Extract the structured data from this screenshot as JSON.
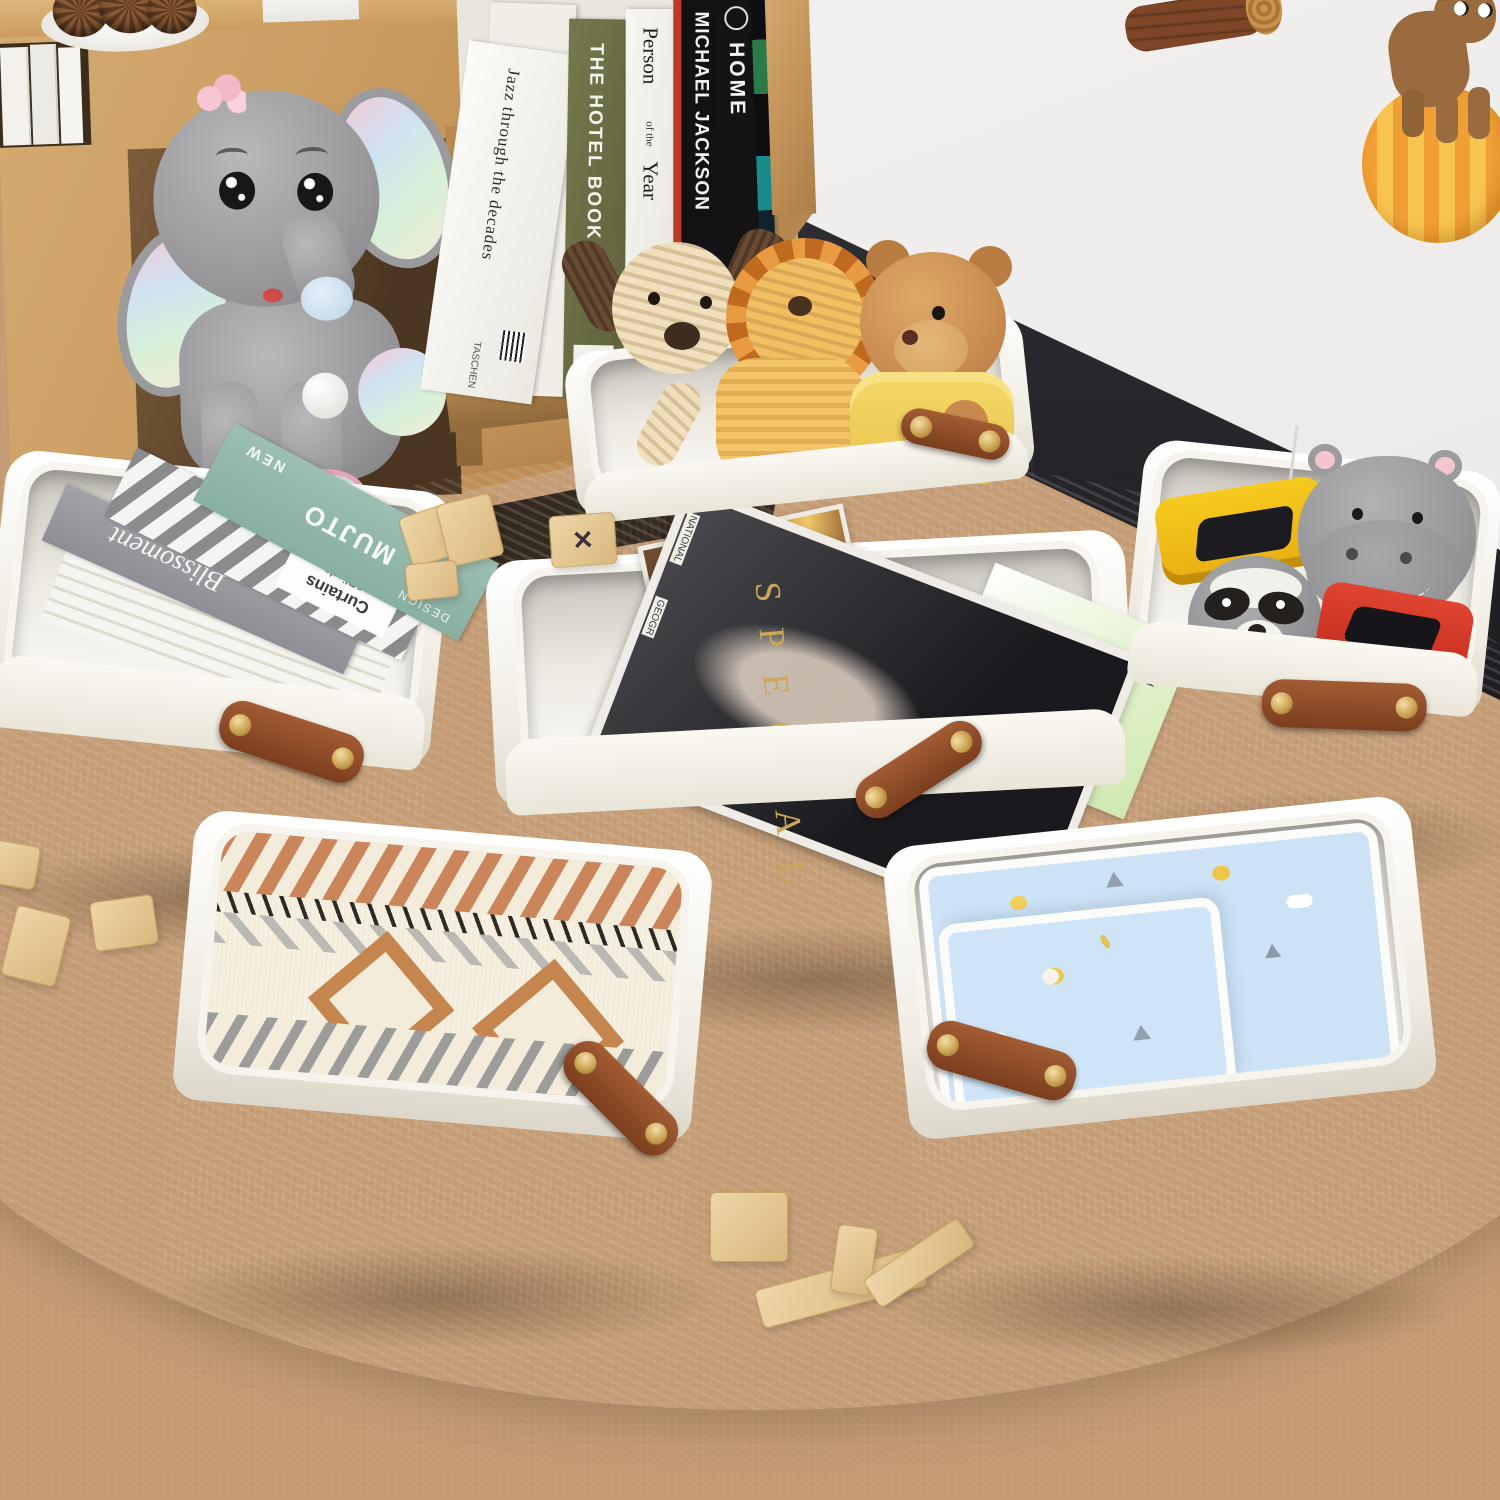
{
  "scene": {
    "type": "product-photo",
    "subject": "Six collapsible two-tone fabric storage baskets (white top, black bottom, brown leather handles with gold rivets) arranged on a round white fluffy rug in a kids playroom",
    "environment": [
      "wooden cube bookshelf",
      "plush elephant in cubby",
      "white wall",
      "dark baseboard",
      "tan carpet floor",
      "wall stickers: log and bear on striped ball",
      "scattered wooden toy blocks",
      "white plate with pinecones"
    ],
    "colors": {
      "carpet_tan": "#c49b73",
      "rug_white": "#f6f4f0",
      "wall_white": "#f0efed",
      "baseboard_dark": "#222228",
      "shelf_wood": "#c59659",
      "basket_white": "#f4f0e7",
      "basket_black": "#17171a",
      "handle_brown": "#8a4a26",
      "rivet_gold": "#c69d4c",
      "elephant_gray": "#9c9c9e",
      "lion_orange": "#e89b40",
      "teddy_brown": "#c8894e",
      "blanket_terracotta": "#c8845a",
      "baby_blanket_blue": "#cde3f5"
    }
  },
  "shelf_books": {
    "jazz": {
      "title": "Jazz through the decades",
      "publisher": "TASCHEN"
    },
    "hotel": {
      "title": "THE HOTEL BOOK"
    },
    "person": {
      "l1": "Person",
      "l2": "of the",
      "l3": "Year",
      "small": "TIM"
    },
    "michael": {
      "title": "MICHAEL JACKSON"
    },
    "home": {
      "title": "HOME"
    }
  },
  "basket_books": {
    "blissoment": "Blissoment",
    "curtains_l1": "Curtains",
    "curtains_l2": "&Blinds",
    "design": "DESIGN",
    "brand": "MUJTO",
    "new": "NEW"
  },
  "magazines": {
    "special": "SPECIAL",
    "natgeo_l1": "NATIONAL",
    "natgeo_l2": "GEOGR",
    "r_letter": "R"
  },
  "blocks": {
    "x_mark": "✕"
  },
  "baskets": [
    {
      "id": "toys-plush",
      "contents": "cream corduroy dog, orange corduroy lion, teddy bear in yellow hoodie"
    },
    {
      "id": "toy-cars",
      "contents": "yellow toy car, gray hippo plush, raccoon plush, red toy car"
    },
    {
      "id": "binders",
      "contents": "Blissoment book, Curtains & Blinds striped book, MUJTO DESIGN NEW teal book"
    },
    {
      "id": "magazines",
      "contents": "SPECIAL fashion magazine, green R magazine, amber photo magazine"
    },
    {
      "id": "knit-blanket",
      "contents": "aztec pattern knit blanket in cream, terracotta, gray, black"
    },
    {
      "id": "baby-blanket",
      "contents": "folded light blue baby blanket with cartoon prints"
    }
  ]
}
